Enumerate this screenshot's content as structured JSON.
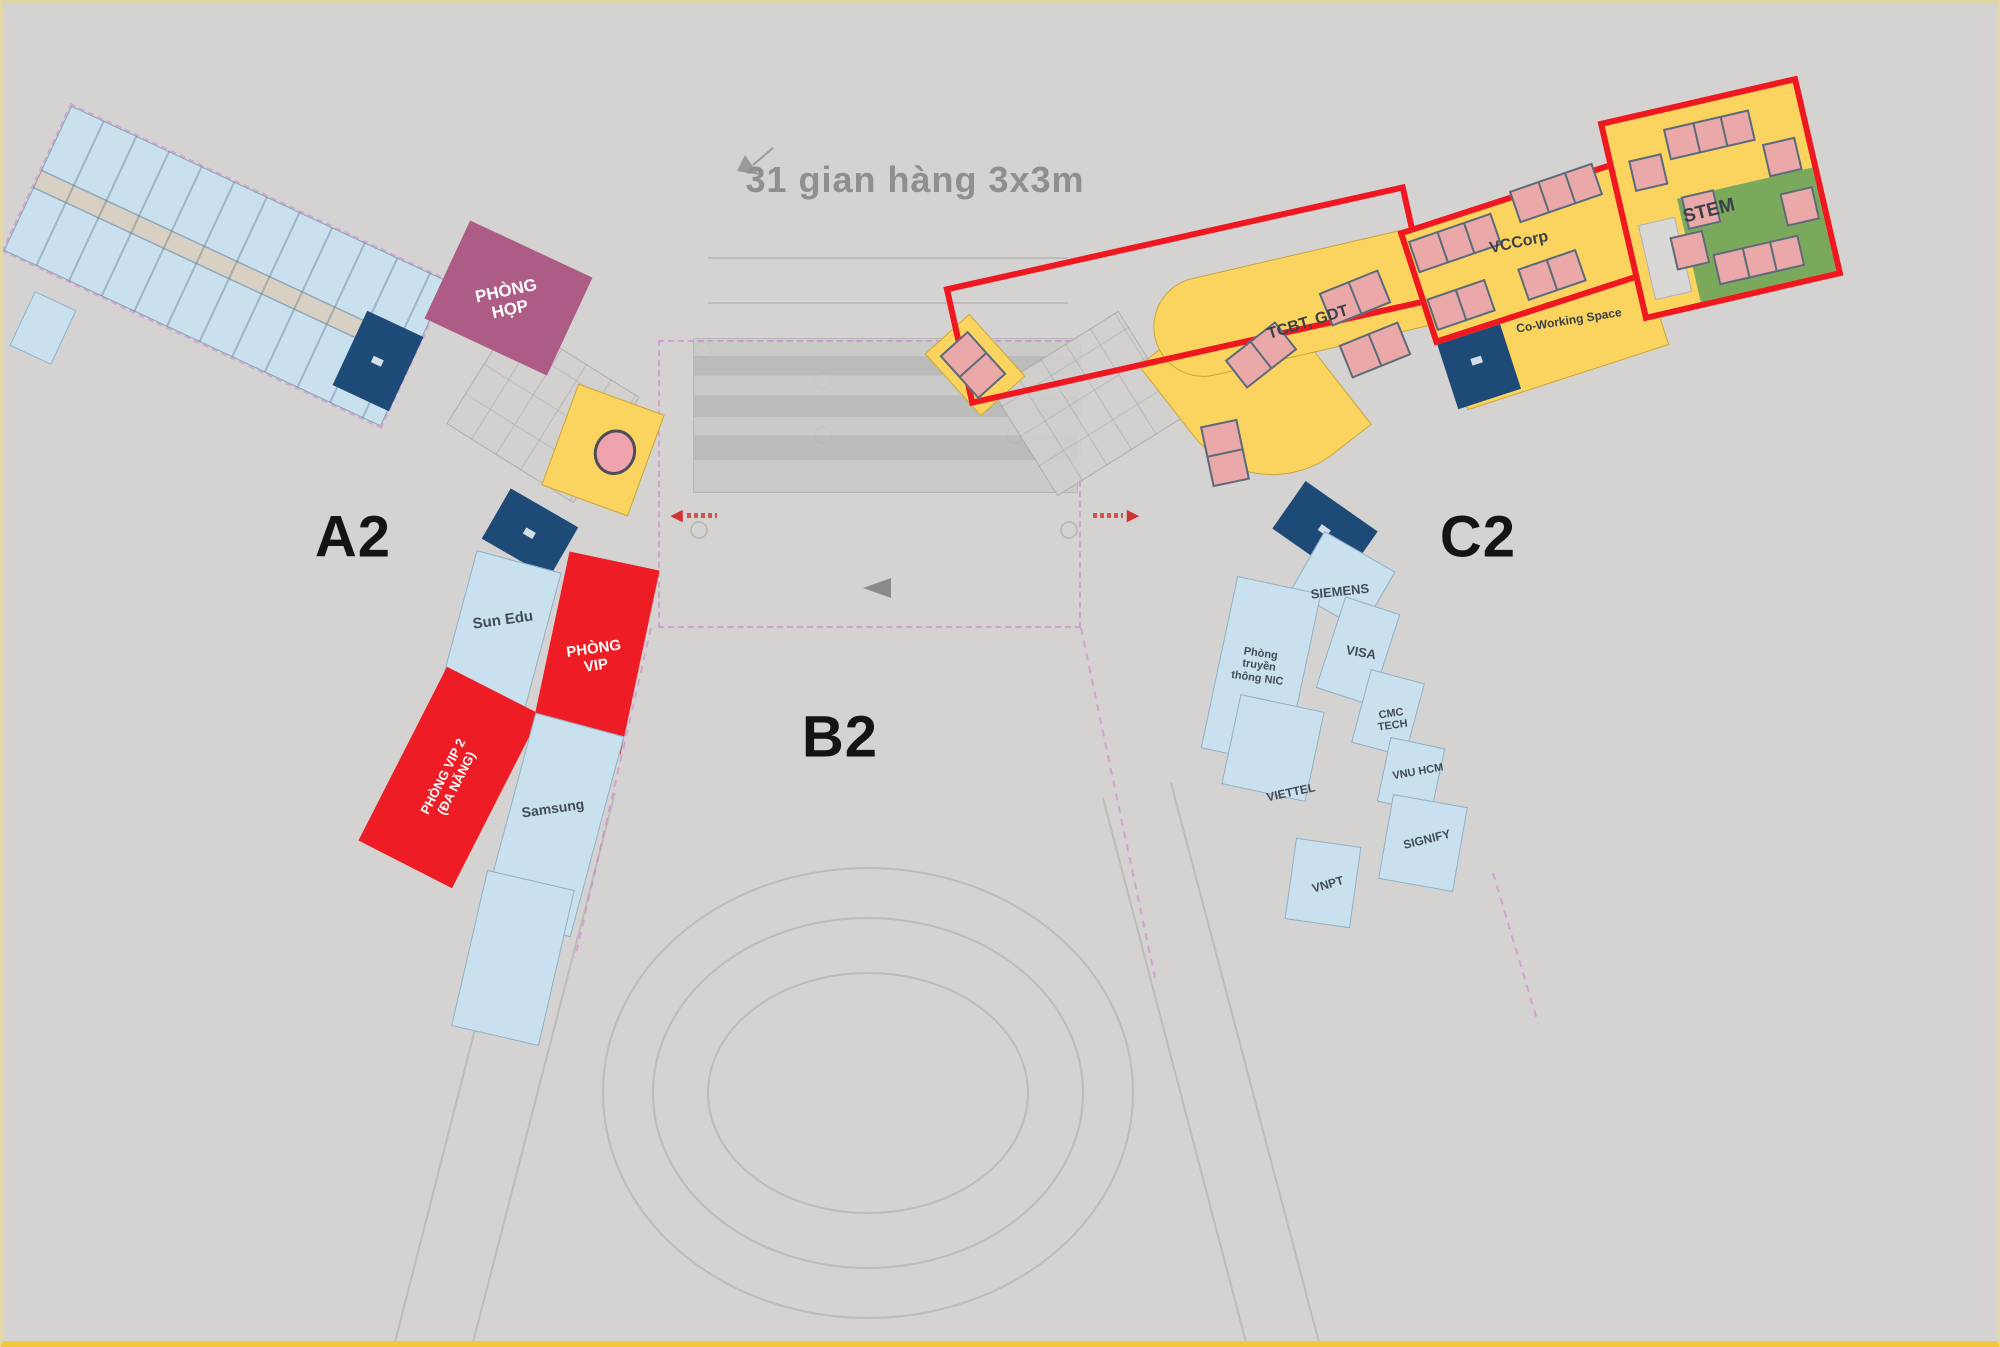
{
  "canvas": {
    "width": 2000,
    "height": 1347
  },
  "title": "31 gian hàng 3x3m",
  "zone_labels": {
    "a2": "A2",
    "b2": "B2",
    "c2": "C2"
  },
  "a2_wing": {
    "phong_hop": {
      "line1": "PHÒNG",
      "line2": "HỌP"
    },
    "sun_edu": "Sun Edu",
    "phong_vip": {
      "line1": "PHÒNG",
      "line2": "VIP"
    },
    "phong_vip_2": {
      "line1": "PHÒNG VIP 2",
      "line2": "(ĐA NĂNG)"
    },
    "samsung": "Samsung"
  },
  "c2_wing": {
    "area_tcbt": "TCBT, GDT",
    "area_vccorp": "VCCorp",
    "area_stem": "STEM",
    "area_coworking": "Co-Working Space",
    "tenants": {
      "siemens": "SIEMENS",
      "nic": {
        "line1": "Phòng",
        "line2": "truyền",
        "line3": "thông NIC"
      },
      "visa": "VISA",
      "cmc": {
        "line1": "CMC",
        "line2": "TECH"
      },
      "vnu_hcm": "VNU HCM",
      "viettel": "VIETTEL",
      "signify": "SIGNIFY",
      "vnpt": "VNPT"
    }
  },
  "colors": {
    "background": "#d4d3d2",
    "booth_fill": "#eba8a8",
    "booth_border": "#5a6b7a",
    "yellow_zone": "#fbd45f",
    "green_zone": "#7aa95c",
    "navy_block": "#1d4a77",
    "light_blue_block": "#c9e0ef",
    "maroon_block": "#ad5c85",
    "red_block": "#ee1c24",
    "red_outline": "#ef1820",
    "dashed_magenta": "#cf7fd0"
  }
}
